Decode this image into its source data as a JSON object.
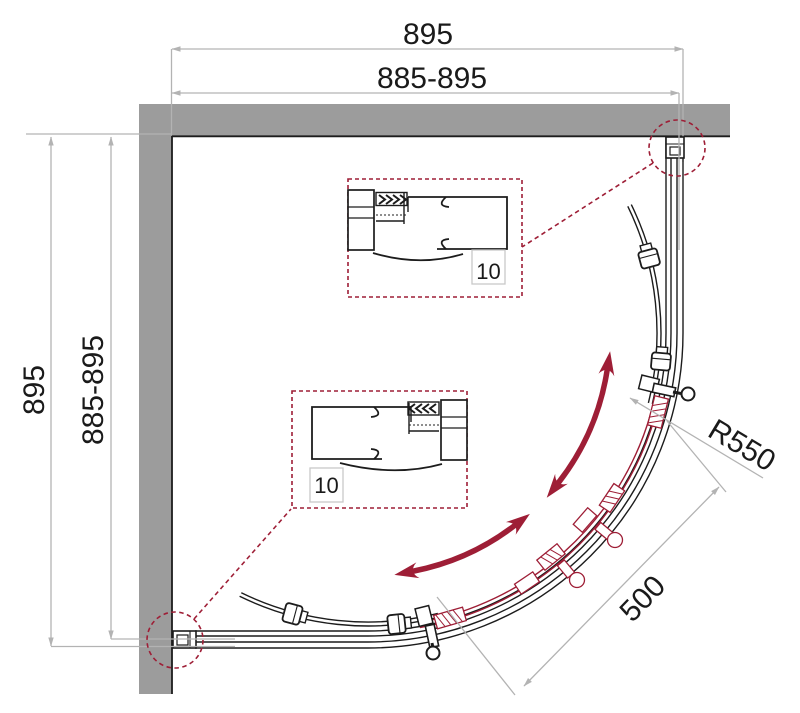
{
  "diagram": {
    "type": "technical_plan_drawing",
    "subject": "Quarter-round corner shower enclosure with curved sliding doors, top-view installation drawing",
    "labels": {
      "dim_top_overall": "895",
      "dim_top_range": "885-895",
      "dim_left_overall": "895",
      "dim_left_range": "885-895",
      "dim_radius": "R550",
      "dim_opening": "500",
      "detail_top_offset": "10",
      "detail_bottom_offset": "10"
    },
    "colors": {
      "wall_gray": "#9c9c9c",
      "dimension_gray": "#b3b3b3",
      "accent_red": "#9e1e36",
      "line_black": "#1c1c1c",
      "background": "#ffffff"
    }
  }
}
